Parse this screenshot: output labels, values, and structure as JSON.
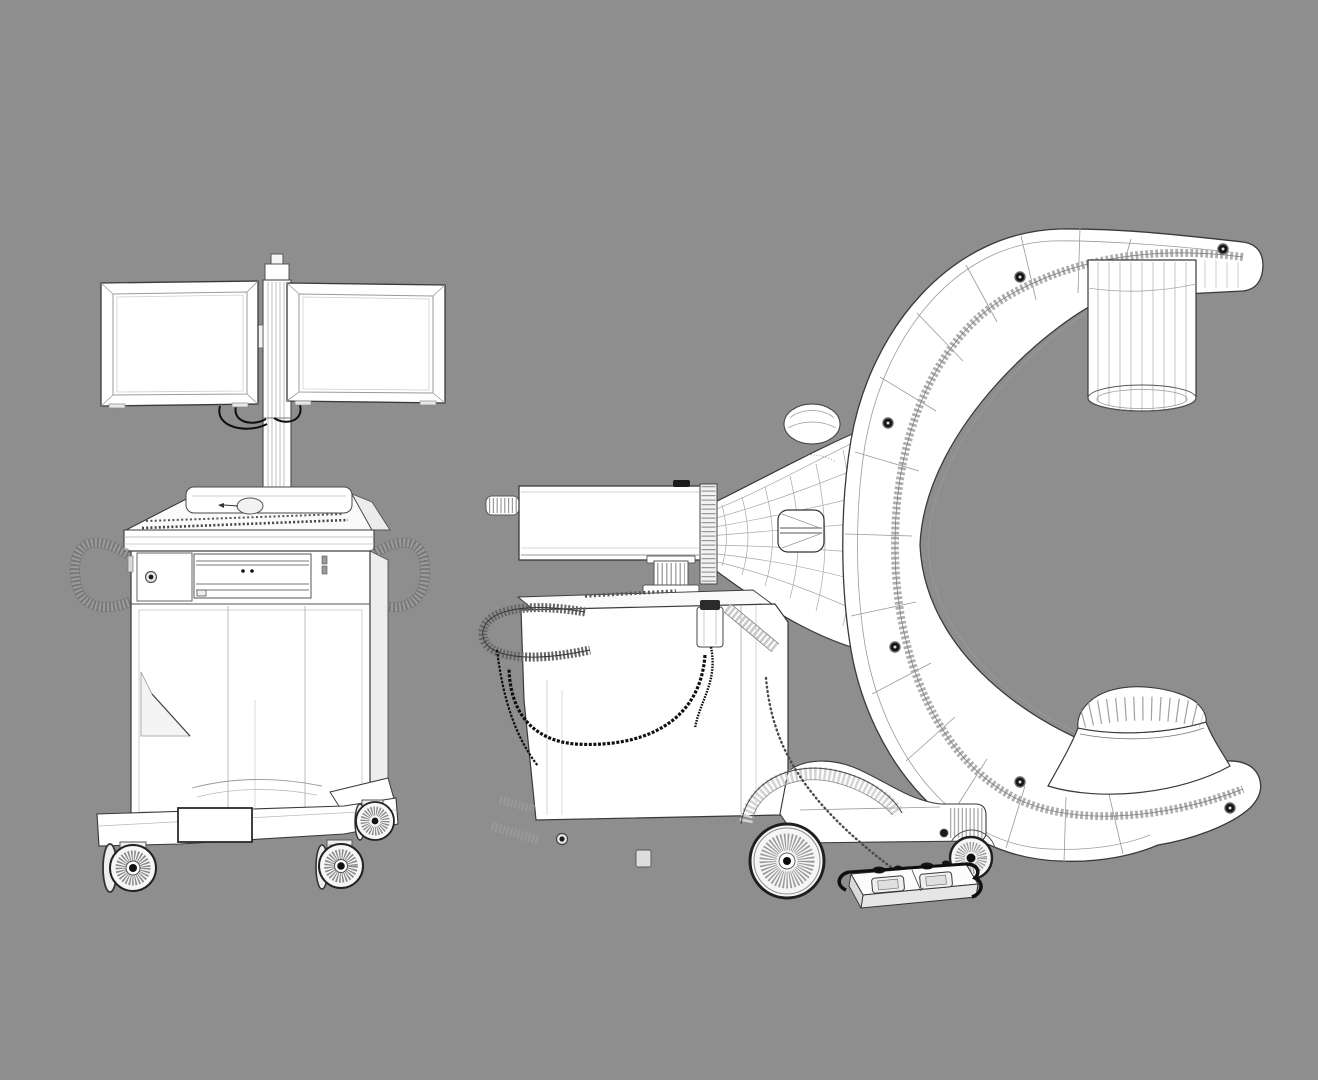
{
  "canvas": {
    "width": 1318,
    "height": 1080,
    "background": "#8e8e8e"
  },
  "colors": {
    "surface": "#ffffff",
    "surface_shade": "#ececec",
    "outline": "#3a3a3a",
    "wire_light": "#9b9b9b",
    "cable_black": "#111111",
    "rack_strip": "#b0b0b0",
    "bolt_black": "#151515"
  },
  "scene": {
    "style": "monochrome 3D wireframe render",
    "object_count": 2
  },
  "objects": {
    "workstation_cart": {
      "label": "dual-monitor workstation cart (front view)",
      "parts": [
        "monitor-left",
        "monitor-right",
        "monitor-pole",
        "keyboard-console",
        "mouse",
        "recorder-drawer",
        "power-button",
        "side-handle-left",
        "side-handle-right",
        "cabinet",
        "base-bumper",
        "casters"
      ]
    },
    "c_arm_unit": {
      "label": "mobile C-arm X-ray machine (side view)",
      "parts": [
        "c-gantry",
        "gear-rack",
        "locking-bolts",
        "image-intensifier",
        "x-ray-tube-housing",
        "carriage-horn",
        "horizontal-arm",
        "support-column",
        "main-body",
        "grab-handle",
        "coiled-cable",
        "cable-holder",
        "front-wheel",
        "rear-wheel",
        "rear-leg",
        "foot-pedal",
        "pedal-cable"
      ]
    }
  }
}
